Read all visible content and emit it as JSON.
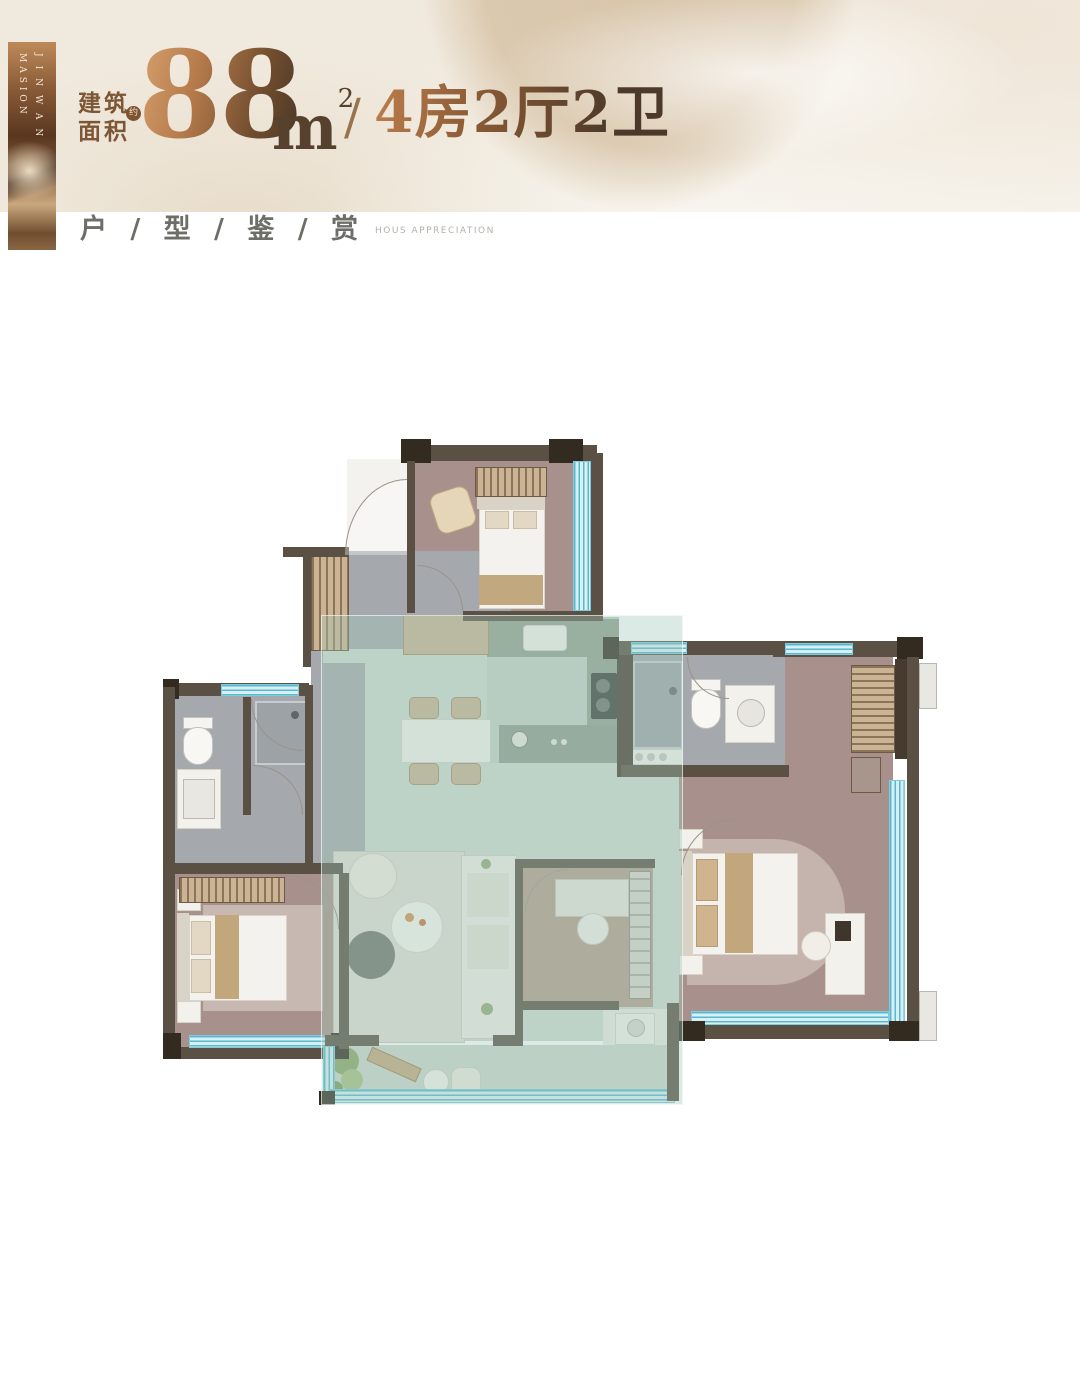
{
  "banner": {
    "vertical_right": "JINWAN",
    "vertical_left": "MASION"
  },
  "header": {
    "area_label_line1": "建筑",
    "area_label_line2": "面积",
    "approx_badge": "约",
    "area_value": "88",
    "area_unit": "m",
    "area_unit_exponent": "2",
    "separator": "/",
    "layout_text": "4房2厅2卫"
  },
  "section": {
    "title_cn": "户 / 型 / 鉴 / 赏",
    "title_en": "HOUS APPRECIATION"
  },
  "palette": {
    "bronze_light": "#d09a67",
    "bronze_dark": "#4e3926",
    "banner_copper": "#8a5c38",
    "wall": "#5a5044",
    "wall_pier": "#332a20",
    "floor_bedroom": "#a8918c",
    "floor_bath": "#a5a8ac",
    "floor_living": "#cfdad1",
    "floor_wood_study": "#b49b8c",
    "kitchen_counter": "#93a08f",
    "window_teal": "#55b9cf",
    "window_glass": "#daeff3",
    "living_overlay": "rgba(163,201,186,0.38)",
    "balcony_plant_green": "#8aa768",
    "silk_beige": "#dbc9af"
  }
}
